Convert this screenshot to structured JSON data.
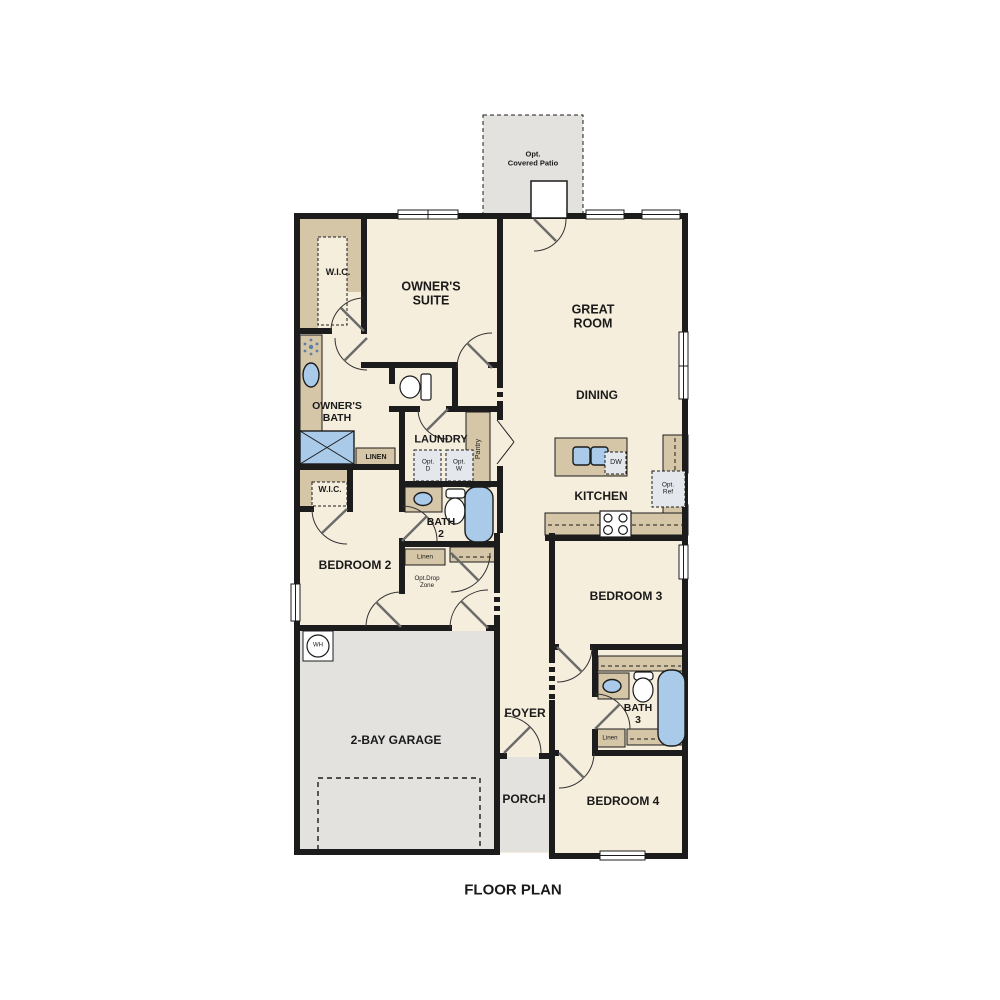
{
  "title": "FLOOR PLAN",
  "colors": {
    "wall": "#1c1c1c",
    "cream": "#f6eedd",
    "tan": "#d5c6a7",
    "gray": "#e3e2df",
    "fixture-blue": "#a9cbe9",
    "optbox": "#e4e7ec",
    "text": "#1a1a1a"
  },
  "rooms": {
    "patio": "Opt.\nCovered Patio",
    "wic_owner": "W.I.C.",
    "owners_suite": "OWNER'S\nSUITE",
    "great_room": "GREAT\nROOM",
    "dining": "DINING",
    "owners_bath": "OWNER'S\nBATH",
    "laundry": "LAUNDRY",
    "wic_bed2": "W.I.C.",
    "bath2": "BATH\n2",
    "kitchen": "KITCHEN",
    "bedroom2": "BEDROOM 2",
    "garage": "2-BAY GARAGE",
    "foyer": "FOYER",
    "bedroom3": "BEDROOM 3",
    "bath3": "BATH\n3",
    "bedroom4": "BEDROOM 4",
    "porch": "PORCH"
  },
  "features": {
    "pantry": "Pantry",
    "linen_owner": "LINEN",
    "linen_hall": "Linen",
    "linen_bath3": "Linen",
    "drop_zone": "Opt.Drop\nZone",
    "opt_dryer": "Opt.\nD",
    "opt_washer": "Opt.\nW",
    "dishwasher": "DW",
    "opt_fridge": "Opt.\nRef",
    "water_heater": "WH"
  }
}
